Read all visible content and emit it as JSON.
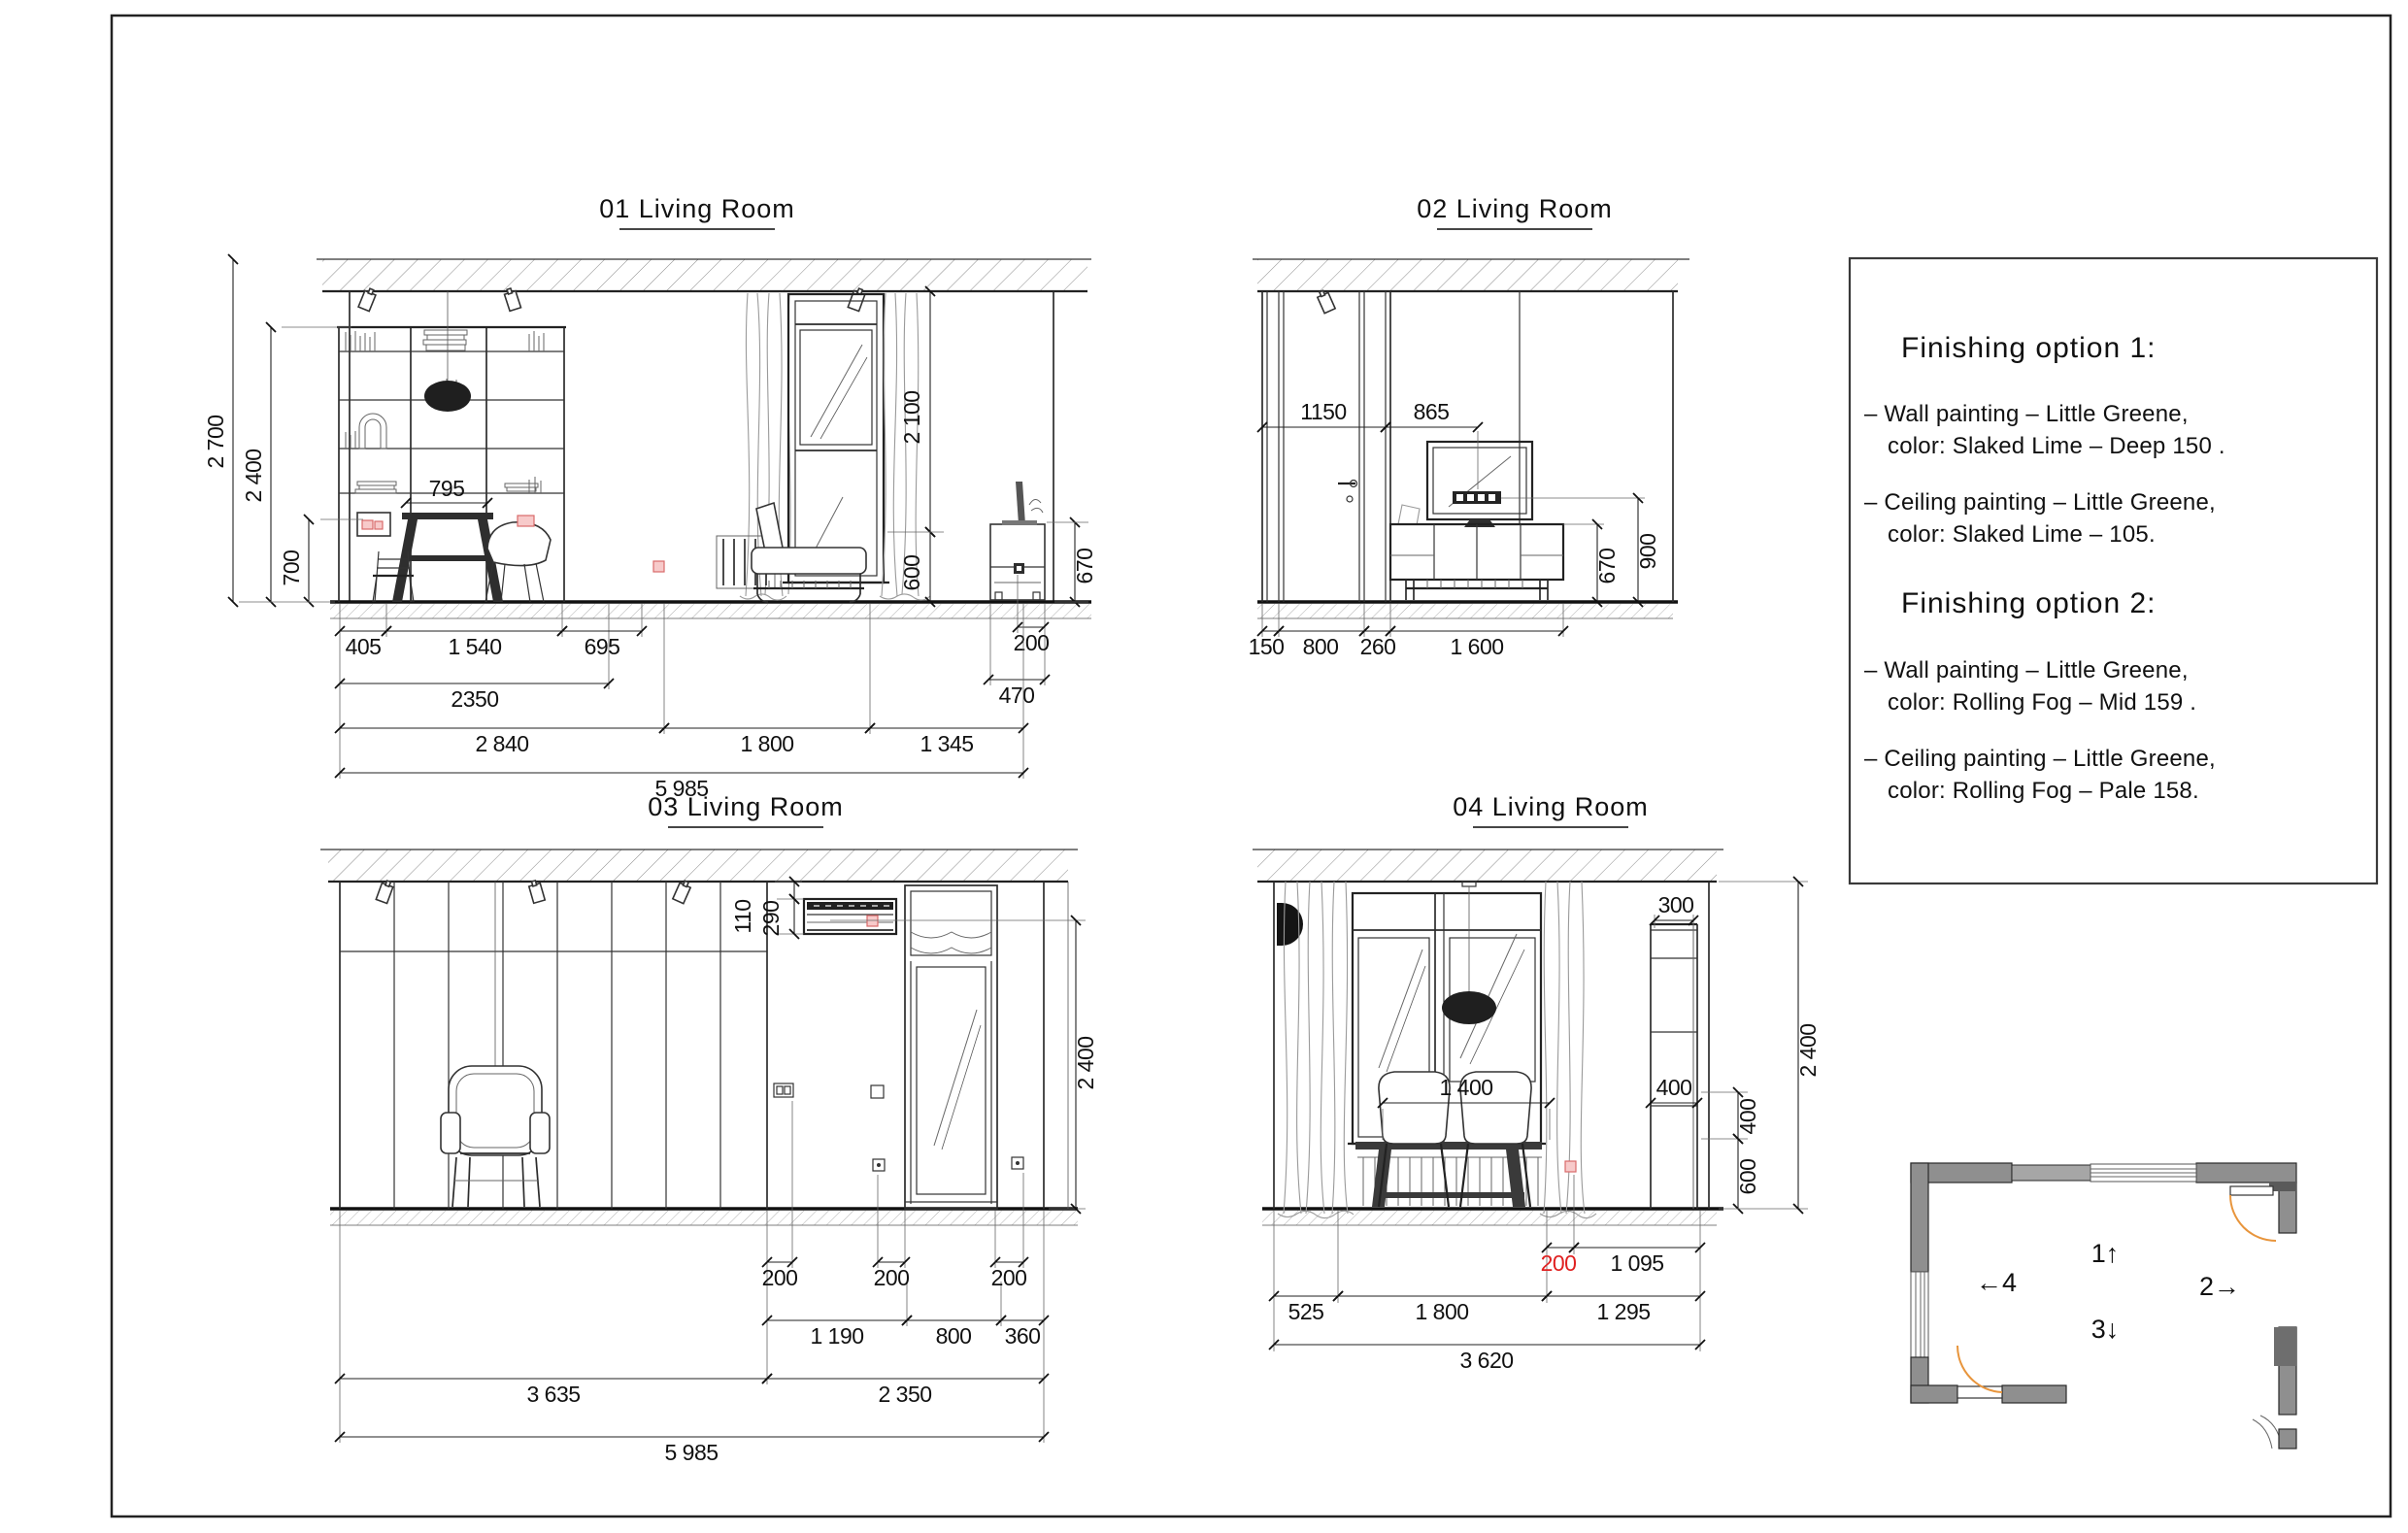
{
  "sheet": {
    "background": "#ffffff",
    "border_color": "#222222"
  },
  "colors": {
    "red_dim": "#e02020",
    "socket_fill": "#f7caca",
    "socket_stroke": "#d96a6a",
    "door_arc_orange": "#e8953c",
    "wall_gray": "#8f8f8f"
  },
  "elevations": {
    "e1": {
      "title": "01 Living Room",
      "dims": {
        "v2700": "2 700",
        "v2400": "2 400",
        "v700": "700",
        "top795": "795",
        "v2100": "2 100",
        "v600": "600",
        "v670": "670",
        "cab200": "200",
        "cab470": "470",
        "b405": "405",
        "b1540": "1 540",
        "b695": "695",
        "b2350": "2350",
        "b2840": "2 840",
        "b1800": "1 800",
        "b1345": "1 345",
        "b5985": "5 985"
      }
    },
    "e2": {
      "title": "02 Living Room",
      "dims": {
        "t1150": "1150",
        "t865": "865",
        "v670": "670",
        "v900": "900",
        "b150": "150",
        "b800": "800",
        "b260": "260",
        "b1600": "1 600"
      }
    },
    "e3": {
      "title": "03 Living Room",
      "dims": {
        "v110": "110",
        "v290": "290",
        "v2400": "2 400",
        "s200a": "200",
        "s200b": "200",
        "s200c": "200",
        "b1190": "1 190",
        "b800": "800",
        "b360": "360",
        "b3635": "3 635",
        "b2350": "2 350",
        "b5985": "5 985"
      }
    },
    "e4": {
      "title": "04 Living Room",
      "dims": {
        "t300": "300",
        "w1400": "1 400",
        "w400": "400",
        "v400": "400",
        "v600": "600",
        "v2400": "2 400",
        "r200": "200",
        "r1095": "1 095",
        "b525": "525",
        "b1800": "1 800",
        "b1295": "1 295",
        "b3620": "3 620"
      }
    }
  },
  "notes": {
    "sections": [
      {
        "title": "Finishing option 1:",
        "items": [
          {
            "l1": "–  Wall painting – Little Greene,",
            "l2": "color: Slaked Lime – Deep 150 ."
          },
          {
            "l1": "– Ceiling painting – Little Greene,",
            "l2": "color: Slaked Lime – 105."
          }
        ]
      },
      {
        "title": "Finishing option 2:",
        "items": [
          {
            "l1": "–  Wall painting – Little Greene,",
            "l2": "color: Rolling Fog – Mid 159 ."
          },
          {
            "l1": "– Ceiling painting – Little Greene,",
            "l2": "color: Rolling Fog – Pale 158."
          }
        ]
      }
    ]
  },
  "plan": {
    "markers": [
      {
        "text": "1↑"
      },
      {
        "text": "2→"
      },
      {
        "text": "3↓"
      },
      {
        "text": "←4"
      }
    ]
  }
}
